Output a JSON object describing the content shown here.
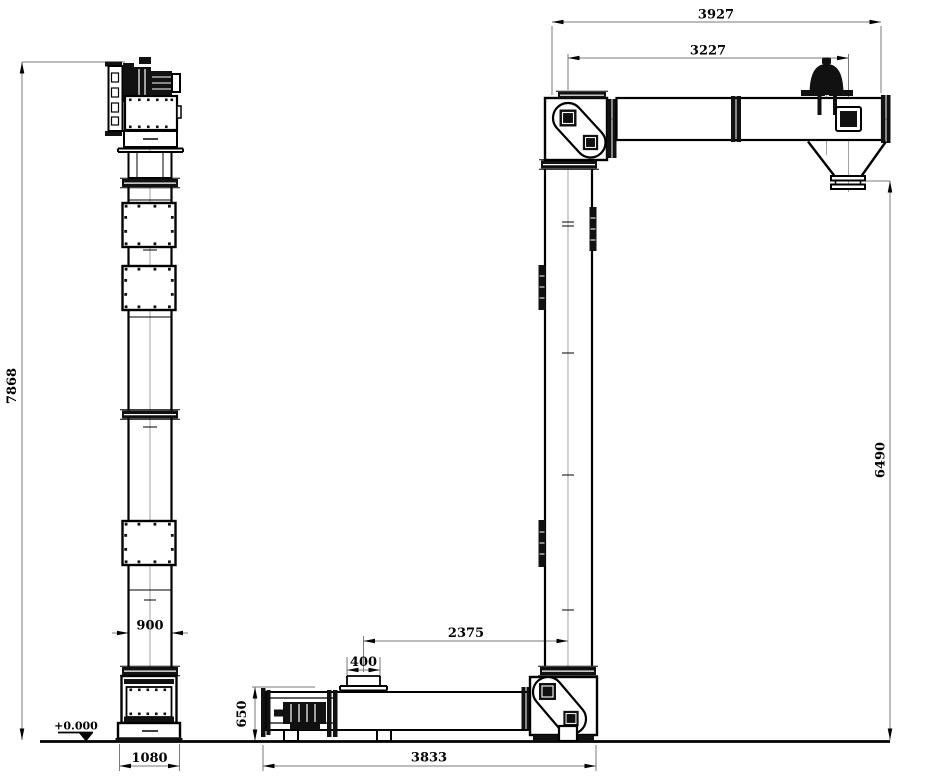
{
  "drawing": {
    "dims": {
      "overall_height": "7868",
      "top_overall": "3927",
      "top_inner": "3227",
      "discharge_drop": "6490",
      "casing_width": "900",
      "inlet_to_column": "2375",
      "inlet_width": "400",
      "bottom_height": "650",
      "base_width": "1080",
      "bottom_length": "3833",
      "ground_level": "+0.000"
    },
    "colors": {
      "line": "#000000",
      "dark_fill": "#111111",
      "dimension_line": "#7a7a7a",
      "centerline": "#9a9a9a",
      "background": "#ffffff"
    }
  }
}
